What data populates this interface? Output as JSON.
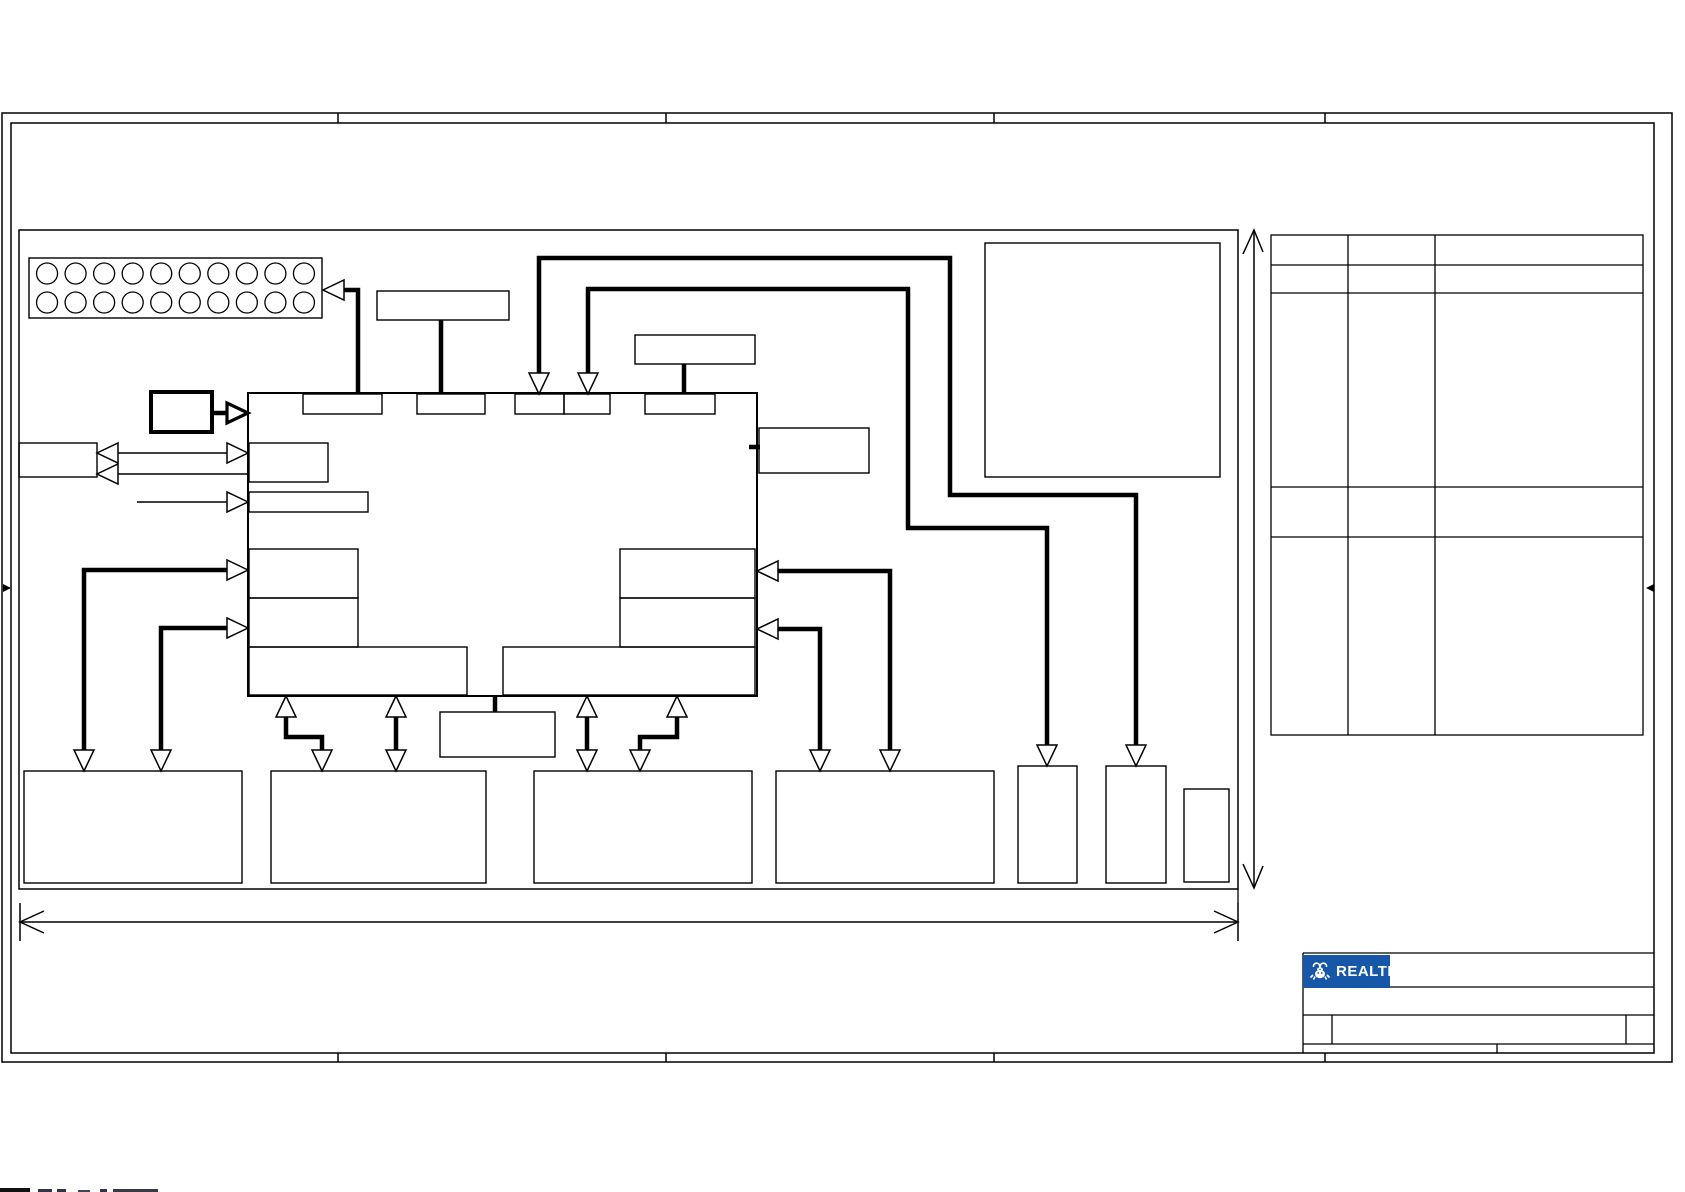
{
  "meta": {
    "description": "Schematic block-diagram sheet with empty component boxes, drawing frame, reference table and Realtek title block",
    "ink": "#000000",
    "background": "#ffffff"
  },
  "logo": {
    "text": "REALTEK",
    "bg": "#1657A8",
    "fg": "#ffffff",
    "icon": "realtek-crab-icon",
    "box": {
      "x": 1303,
      "y": 955,
      "w": 87,
      "h": 33
    }
  },
  "frame": {
    "outer": {
      "x": 2,
      "y": 113,
      "w": 1670,
      "h": 949
    },
    "inner": {
      "x": 11,
      "y": 123,
      "w": 1643,
      "h": 930
    },
    "tick_xs": [
      338,
      666,
      994,
      1325
    ],
    "center_marker_y": 588
  },
  "diagram_box": {
    "x": 19,
    "y": 230,
    "w": 1219,
    "h": 659
  },
  "connector": {
    "x": 29,
    "y": 258,
    "w": 293,
    "h": 60,
    "rows": 2,
    "cols": 10,
    "circle_d": 21
  },
  "chip": {
    "name": "main-chip-outline",
    "x": 248,
    "y": 393,
    "w": 509,
    "h": 303,
    "sw": 2
  },
  "boxes": [
    {
      "name": "osc-box",
      "x": 377,
      "y": 291,
      "w": 132,
      "h": 29
    },
    {
      "name": "top-box-2",
      "x": 635,
      "y": 335,
      "w": 120,
      "h": 29
    },
    {
      "name": "right-side-box",
      "x": 759,
      "y": 428,
      "w": 110,
      "h": 45
    },
    {
      "name": "crystal-box",
      "x": 151,
      "y": 392,
      "w": 61,
      "h": 40,
      "sw": 4
    },
    {
      "name": "left-io-box",
      "x": 19,
      "y": 443,
      "w": 78,
      "h": 34
    },
    {
      "name": "big-topright-box",
      "x": 985,
      "y": 243,
      "w": 235,
      "h": 234
    },
    {
      "name": "pin-box-1",
      "x": 303,
      "y": 394,
      "w": 79,
      "h": 20
    },
    {
      "name": "pin-box-2",
      "x": 417,
      "y": 394,
      "w": 68,
      "h": 20
    },
    {
      "name": "pin-box-3",
      "x": 515,
      "y": 394,
      "w": 49,
      "h": 20
    },
    {
      "name": "pin-box-4",
      "x": 564,
      "y": 394,
      "w": 46,
      "h": 20
    },
    {
      "name": "pin-box-5",
      "x": 645,
      "y": 394,
      "w": 70,
      "h": 20
    },
    {
      "name": "chip-left-box-1",
      "x": 249,
      "y": 443,
      "w": 79,
      "h": 39
    },
    {
      "name": "chip-left-box-2",
      "x": 249,
      "y": 492,
      "w": 119,
      "h": 20
    },
    {
      "name": "chip-left-box-3",
      "x": 249,
      "y": 549,
      "w": 109,
      "h": 49
    },
    {
      "name": "chip-left-box-4",
      "x": 249,
      "y": 598,
      "w": 109,
      "h": 49
    },
    {
      "name": "chip-right-box-1",
      "x": 620,
      "y": 549,
      "w": 135,
      "h": 49
    },
    {
      "name": "chip-right-box-2",
      "x": 620,
      "y": 598,
      "w": 135,
      "h": 49
    },
    {
      "name": "chip-bottom-box-left",
      "x": 249,
      "y": 647,
      "w": 218,
      "h": 48
    },
    {
      "name": "chip-bottom-box-right",
      "x": 503,
      "y": 647,
      "w": 252,
      "h": 48
    },
    {
      "name": "bottom-box-1",
      "x": 24,
      "y": 771,
      "w": 218,
      "h": 112
    },
    {
      "name": "bottom-box-2",
      "x": 271,
      "y": 771,
      "w": 215,
      "h": 112
    },
    {
      "name": "bottom-box-3",
      "x": 534,
      "y": 771,
      "w": 218,
      "h": 112
    },
    {
      "name": "bottom-box-4",
      "x": 776,
      "y": 771,
      "w": 218,
      "h": 112
    },
    {
      "name": "small-box-1",
      "x": 1018,
      "y": 766,
      "w": 59,
      "h": 117
    },
    {
      "name": "small-box-2",
      "x": 1106,
      "y": 766,
      "w": 60,
      "h": 117
    },
    {
      "name": "small-box-3",
      "x": 1184,
      "y": 789,
      "w": 45,
      "h": 93
    },
    {
      "name": "mid-bottom-box",
      "x": 440,
      "y": 712,
      "w": 115,
      "h": 45
    }
  ],
  "thick_wires": [
    {
      "name": "wire-connector",
      "pts": [
        [
          343,
          290
        ],
        [
          358,
          290
        ],
        [
          358,
          392
        ]
      ]
    },
    {
      "name": "wire-osc",
      "pts": [
        [
          441,
          320
        ],
        [
          441,
          392
        ]
      ]
    },
    {
      "name": "wire-topbox2",
      "pts": [
        [
          684,
          364
        ],
        [
          684,
          392
        ]
      ]
    },
    {
      "name": "wire-route-a",
      "pts": [
        [
          539,
          373
        ],
        [
          539,
          258
        ],
        [
          950,
          258
        ],
        [
          950,
          495
        ],
        [
          1136,
          495
        ],
        [
          1136,
          746
        ]
      ]
    },
    {
      "name": "wire-route-b",
      "pts": [
        [
          588,
          373
        ],
        [
          588,
          289
        ],
        [
          908,
          289
        ],
        [
          908,
          528
        ],
        [
          1047,
          528
        ],
        [
          1047,
          746
        ]
      ]
    },
    {
      "name": "wire-crystal",
      "pts": [
        [
          212,
          413
        ],
        [
          230,
          413
        ]
      ]
    },
    {
      "name": "wire-left-1",
      "pts": [
        [
          228,
          570
        ],
        [
          84,
          570
        ],
        [
          84,
          751
        ]
      ]
    },
    {
      "name": "wire-left-2",
      "pts": [
        [
          228,
          628
        ],
        [
          161,
          628
        ],
        [
          161,
          751
        ]
      ]
    },
    {
      "name": "wire-right-1",
      "pts": [
        [
          777,
          571
        ],
        [
          890,
          571
        ],
        [
          890,
          751
        ]
      ]
    },
    {
      "name": "wire-right-2",
      "pts": [
        [
          777,
          629
        ],
        [
          820,
          629
        ],
        [
          820,
          751
        ]
      ]
    },
    {
      "name": "wire-bus-1",
      "pts": [
        [
          396,
          716
        ],
        [
          396,
          751
        ]
      ]
    },
    {
      "name": "wire-bus-2",
      "pts": [
        [
          587,
          716
        ],
        [
          587,
          751
        ]
      ]
    },
    {
      "name": "wire-elbow-left",
      "pts": [
        [
          286,
          716
        ],
        [
          286,
          737
        ],
        [
          322,
          737
        ],
        [
          322,
          751
        ]
      ]
    },
    {
      "name": "wire-elbow-right",
      "pts": [
        [
          677,
          716
        ],
        [
          677,
          737
        ],
        [
          640,
          737
        ],
        [
          640,
          751
        ]
      ]
    },
    {
      "name": "wire-midbox-stub",
      "pts": [
        [
          495,
          697
        ],
        [
          495,
          712
        ]
      ]
    },
    {
      "name": "wire-rightbox-stub",
      "pts": [
        [
          749,
          447
        ],
        [
          760,
          447
        ]
      ]
    }
  ],
  "thin_wires": [
    {
      "name": "line-io-upper",
      "pts": [
        [
          118,
          453
        ],
        [
          227,
          453
        ]
      ]
    },
    {
      "name": "line-io-lower",
      "pts": [
        [
          118,
          474
        ],
        [
          248,
          474
        ]
      ]
    },
    {
      "name": "line-single",
      "pts": [
        [
          137,
          502
        ],
        [
          227,
          502
        ]
      ]
    }
  ],
  "arrowheads": [
    {
      "name": "arrow-into-connector",
      "tip": [
        323,
        290
      ],
      "dir": "left"
    },
    {
      "name": "arrow-pin3-down",
      "tip": [
        539,
        394
      ],
      "dir": "down"
    },
    {
      "name": "arrow-pin4-down",
      "tip": [
        588,
        394
      ],
      "dir": "down"
    },
    {
      "name": "arrow-smallbox2-down",
      "tip": [
        1136,
        766
      ],
      "dir": "down"
    },
    {
      "name": "arrow-smallbox1-down",
      "tip": [
        1047,
        766
      ],
      "dir": "down"
    },
    {
      "name": "arrow-crystal-right",
      "tip": [
        248,
        413
      ],
      "dir": "right",
      "thick": true
    },
    {
      "name": "arrow-io-left-1",
      "tip": [
        97,
        453
      ],
      "dir": "left"
    },
    {
      "name": "arrow-io-left-2",
      "tip": [
        97,
        474
      ],
      "dir": "left"
    },
    {
      "name": "arrow-chipleft-1",
      "tip": [
        248,
        453
      ],
      "dir": "right"
    },
    {
      "name": "arrow-chipleft-2",
      "tip": [
        248,
        502
      ],
      "dir": "right"
    },
    {
      "name": "arrow-chipleft-3",
      "tip": [
        248,
        570
      ],
      "dir": "right"
    },
    {
      "name": "arrow-chipleft-4",
      "tip": [
        248,
        628
      ],
      "dir": "right"
    },
    {
      "name": "arrow-b1-a",
      "tip": [
        84,
        771
      ],
      "dir": "down"
    },
    {
      "name": "arrow-b1-b",
      "tip": [
        161,
        771
      ],
      "dir": "down"
    },
    {
      "name": "arrow-chipright-1",
      "tip": [
        757,
        571
      ],
      "dir": "left"
    },
    {
      "name": "arrow-chipright-2",
      "tip": [
        757,
        629
      ],
      "dir": "left"
    },
    {
      "name": "arrow-b4-a",
      "tip": [
        890,
        771
      ],
      "dir": "down"
    },
    {
      "name": "arrow-b4-b",
      "tip": [
        820,
        771
      ],
      "dir": "down"
    },
    {
      "name": "arrow-bus1-up",
      "tip": [
        396,
        696
      ],
      "dir": "up"
    },
    {
      "name": "arrow-bus1-down",
      "tip": [
        396,
        771
      ],
      "dir": "down"
    },
    {
      "name": "arrow-bus2-up",
      "tip": [
        587,
        696
      ],
      "dir": "up"
    },
    {
      "name": "arrow-bus2-down",
      "tip": [
        587,
        771
      ],
      "dir": "down"
    },
    {
      "name": "arrow-elbowL-up",
      "tip": [
        286,
        696
      ],
      "dir": "up"
    },
    {
      "name": "arrow-elbowL-down",
      "tip": [
        322,
        771
      ],
      "dir": "down"
    },
    {
      "name": "arrow-elbowR-up",
      "tip": [
        677,
        696
      ],
      "dir": "up"
    },
    {
      "name": "arrow-elbowR-down",
      "tip": [
        640,
        771
      ],
      "dir": "down"
    }
  ],
  "dim_vertical": {
    "x": 1254,
    "y1": 230,
    "y2": 888
  },
  "dim_horizontal": {
    "y": 922,
    "x1": 20,
    "x2": 1238,
    "bar_half": 19
  },
  "reference_table": {
    "x1": 1271,
    "x2": 1643,
    "col_xs": [
      1348,
      1435
    ],
    "row_ys": [
      235,
      265,
      293,
      487,
      537,
      735
    ]
  },
  "title_block": {
    "x1": 1303,
    "x2": 1654,
    "row_ys": [
      953,
      987,
      1015,
      1044
    ],
    "bottom_y": 1053,
    "row3_dividers": [
      1332,
      1626
    ],
    "strip_divider": 1497
  },
  "fragments": [
    {
      "x": 0,
      "y": 1188,
      "w": 30,
      "h": 4,
      "c": "#111111"
    },
    {
      "x": 38,
      "y": 1189,
      "w": 14,
      "h": 3,
      "c": "#333344"
    },
    {
      "x": 57,
      "y": 1189,
      "w": 9,
      "h": 3,
      "c": "#333344"
    },
    {
      "x": 78,
      "y": 1190,
      "w": 12,
      "h": 2,
      "c": "#444455"
    },
    {
      "x": 100,
      "y": 1189,
      "w": 7,
      "h": 3,
      "c": "#333344"
    },
    {
      "x": 113,
      "y": 1189,
      "w": 45,
      "h": 3,
      "c": "#3a3a46"
    }
  ]
}
